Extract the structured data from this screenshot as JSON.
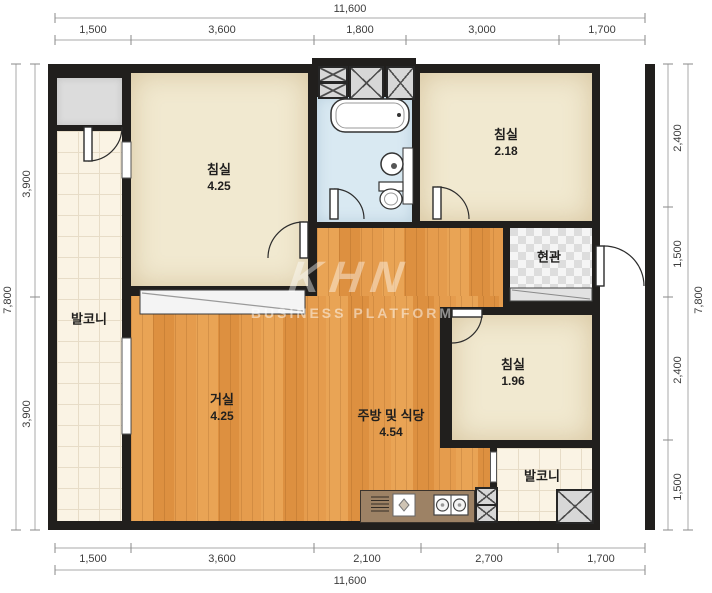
{
  "watermark": {
    "logo": "KHN",
    "subtitle": "BUSINESS PLATFORM"
  },
  "rooms": {
    "bedroom_tl": {
      "name": "침실",
      "area": "4.25"
    },
    "bedroom_tr": {
      "name": "침실",
      "area": "2.18"
    },
    "bedroom_r": {
      "name": "침실",
      "area": "1.96"
    },
    "living": {
      "name": "거실",
      "area": "4.25"
    },
    "kitchen": {
      "name": "주방 및 식당",
      "area": "4.54"
    },
    "entrance": {
      "name": "현관"
    },
    "balcony_left": {
      "name": "발코니"
    },
    "balcony_br": {
      "name": "발코니"
    }
  },
  "dimensions": {
    "top": {
      "total": "11,600",
      "segments": [
        "1,500",
        "3,600",
        "1,800",
        "3,000",
        "1,700"
      ]
    },
    "bottom": {
      "total": "11,600",
      "segments": [
        "1,500",
        "3,600",
        "2,100",
        "2,700",
        "1,700"
      ]
    },
    "left": {
      "total": "7,800",
      "segments": [
        "3,900",
        "3,900"
      ]
    },
    "right": {
      "total": "7,800",
      "segments": [
        "2,400",
        "1,500",
        "2,400",
        "1,500"
      ]
    }
  },
  "colors": {
    "wall": "#211f1d",
    "wood": "#e09648",
    "cream": "#f1e9d0",
    "tile": "#faf3e4",
    "bath": "#d9e9f2",
    "gray": "#dcdcdc"
  }
}
